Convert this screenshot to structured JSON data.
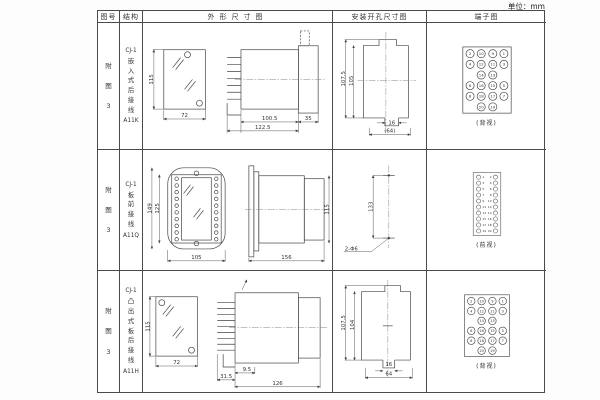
{
  "unit_label": "单位：mm",
  "columns": [
    "图号",
    "结构",
    "外形尺寸图",
    "安装开孔尺寸图",
    "端子图"
  ],
  "rows": [
    {
      "fig_no": "附图3",
      "model": "CJ-1",
      "structure_desc": "嵌入式后接线",
      "type_code": "A11K",
      "outline": {
        "height": "115",
        "width": "72",
        "d1": "100.5",
        "d2": "122.5",
        "d3": "35"
      },
      "mounting": {
        "v1": "107.5",
        "v2": "105",
        "h1": "16",
        "h2": "(64)"
      },
      "terminal": {
        "label": "(背视)",
        "pattern": "grid4",
        "outer_left": [
          "2",
          "4",
          "6",
          "8"
        ],
        "outer_right": [
          "1",
          "3",
          "5",
          "7"
        ],
        "inner_left": [
          "10",
          "12",
          "14",
          "16",
          "18",
          "20"
        ],
        "inner_right": [
          "9",
          "11",
          "13",
          "15",
          "17",
          "19"
        ]
      }
    },
    {
      "fig_no": "附图3",
      "model": "CJ-1",
      "structure_desc": "板前接线",
      "type_code": "A11Q",
      "outline": {
        "h_outer": "149",
        "h_inner": "125",
        "width": "105",
        "depth": "156",
        "height": "115"
      },
      "mounting": {
        "v1": "133",
        "holes": "2-Φ6"
      },
      "terminal": {
        "label": "(前视)",
        "pattern": "two_col",
        "left": [
          "1",
          "3",
          "5",
          "7",
          "9",
          "11",
          "13",
          "15",
          "17",
          "19"
        ],
        "right": [
          "2",
          "4",
          "6",
          "8",
          "10",
          "12",
          "14",
          "16",
          "18",
          "20"
        ]
      }
    },
    {
      "fig_no": "附图3",
      "model": "CJ-1",
      "structure_desc": "凸出式板后接线",
      "type_code": "A11H",
      "outline": {
        "height": "115",
        "width": "72",
        "d1": "31.5",
        "d2": "9.5",
        "d3": "126"
      },
      "mounting": {
        "v1": "107.5",
        "v2": "104",
        "h1": "16",
        "h2": "64"
      },
      "terminal": {
        "label": "(背视)",
        "pattern": "grid4",
        "outer_left": [
          "2",
          "4",
          "6",
          "8"
        ],
        "outer_right": [
          "1",
          "3",
          "5",
          "7"
        ],
        "inner_left": [
          "10",
          "12",
          "14",
          "16",
          "18",
          "20"
        ],
        "inner_right": [
          "9",
          "11",
          "13",
          "15",
          "17",
          "19"
        ]
      }
    }
  ]
}
